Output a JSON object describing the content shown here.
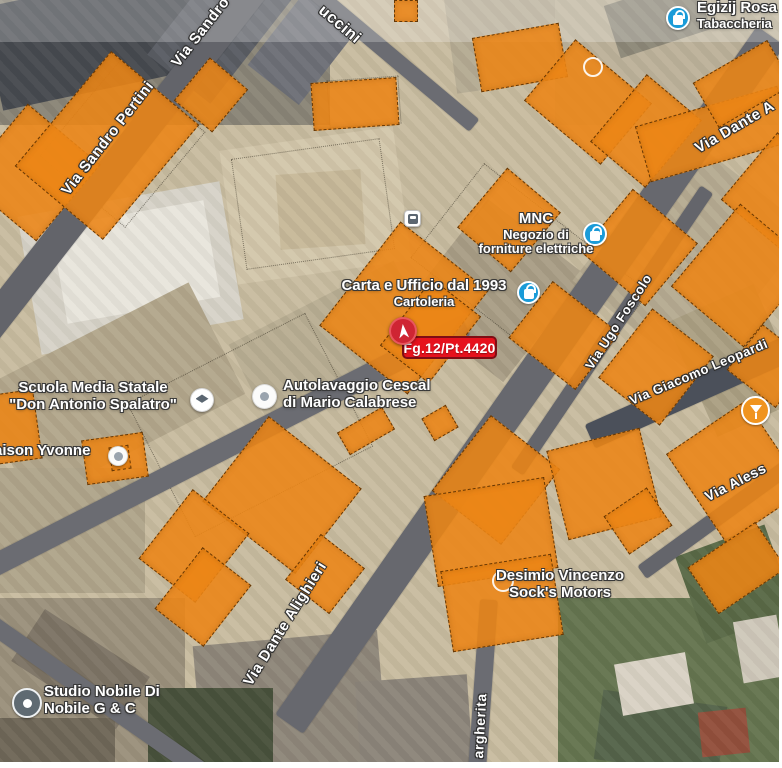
{
  "map": {
    "palette": {
      "map_bg": "#c8bca0",
      "parcel_fill": "#ec8516",
      "parcel_border": "#502a00",
      "road": "#63646a",
      "label_text": "#ffffff",
      "label_outline": "#2f2f2f",
      "badge_bg": "#e6121d",
      "badge_border": "#7e0d14",
      "marker_bg": "#cf2533",
      "poi_blue": "#1a9bd8",
      "poi_orange": "#f0941f",
      "poi_dark_pin": "#5f6a72"
    },
    "badge": {
      "label": "Fg.12/Pt.4420",
      "x": 402,
      "y": 336,
      "w": 95,
      "h": 23
    },
    "marker": {
      "x": 389,
      "y": 317,
      "d": 28
    },
    "streets": [
      {
        "label": "Via Sandro Pertini",
        "x": 58,
        "y": 188,
        "rot": -52,
        "fs": 15
      },
      {
        "label": "Via Sandro",
        "x": 168,
        "y": 60,
        "rot": -52,
        "fs": 15
      },
      {
        "label": "uccini",
        "x": 326,
        "y": 2,
        "rot": 40,
        "fs": 16
      },
      {
        "label": "Via Dante A",
        "x": 692,
        "y": 142,
        "rot": -30,
        "fs": 15
      },
      {
        "label": "Via Ugo Foscolo",
        "x": 582,
        "y": 364,
        "rot": -57,
        "fs": 13
      },
      {
        "label": "Via Giacomo Leopardi",
        "x": 627,
        "y": 394,
        "rot": -23,
        "fs": 13
      },
      {
        "label": "Via Aless",
        "x": 702,
        "y": 490,
        "rot": -27,
        "fs": 14
      },
      {
        "label": "Via Dante Alighieri",
        "x": 240,
        "y": 680,
        "rot": -58,
        "fs": 15
      },
      {
        "label": "argherita",
        "x": 470,
        "y": 758,
        "rot": -87,
        "fs": 14
      }
    ],
    "pois": [
      {
        "id": "tabaccheria",
        "icon": {
          "type": "bag",
          "x": 666,
          "y": 6,
          "d": 24
        },
        "text": {
          "align": "left",
          "x": 697,
          "y": 0,
          "lines": [
            "Egizij Rosa",
            "Tabaccheria"
          ],
          "fs": [
            15,
            13
          ]
        }
      },
      {
        "id": "mnc",
        "icon": {
          "type": "bag",
          "x": 583,
          "y": 222,
          "d": 24
        },
        "text": {
          "align": "center",
          "cx": 536,
          "y": 211,
          "lines": [
            "MNC",
            "Negozio di",
            "forniture elettriche"
          ],
          "fs": [
            15,
            13,
            13
          ]
        }
      },
      {
        "id": "cartoleria",
        "icon": {
          "type": "bag",
          "x": 517,
          "y": 281,
          "d": 23
        },
        "text": {
          "align": "center",
          "cx": 424,
          "y": 278,
          "lines": [
            "Carta e Ufficio dal 1993",
            "Cartoleria"
          ],
          "fs": [
            15,
            13
          ]
        }
      },
      {
        "id": "autolavaggio",
        "icon": {
          "type": "carwash",
          "x": 252,
          "y": 384,
          "d": 25
        },
        "text": {
          "align": "left",
          "x": 283,
          "y": 378,
          "lines": [
            "Autolavaggio Cescal",
            "di Mario Calabrese"
          ],
          "fs": [
            15,
            15
          ]
        }
      },
      {
        "id": "scuola",
        "icon": {
          "type": "school",
          "x": 190,
          "y": 388,
          "d": 24
        },
        "text": {
          "align": "center",
          "cx": 93,
          "y": 380,
          "lines": [
            "Scuola Media Statale",
            "\"Don Antonio Spalatro\""
          ],
          "fs": [
            15,
            15
          ]
        }
      },
      {
        "id": "yvonne",
        "icon": {
          "type": "carwash",
          "x": 108,
          "y": 446,
          "d": 20
        },
        "text": {
          "align": "left",
          "x": -6,
          "y": 443,
          "lines": [
            "aison Yvonne"
          ],
          "fs": [
            15
          ]
        }
      },
      {
        "id": "studio-nobile",
        "icon": {
          "type": "pin",
          "x": 12,
          "y": 688,
          "d": 30
        },
        "text": {
          "align": "left",
          "x": 44,
          "y": 684,
          "lines": [
            "Studio Nobile Di",
            "Nobile G & C"
          ],
          "fs": [
            15,
            15
          ]
        }
      },
      {
        "id": "desimio",
        "icon": {
          "type": "ring",
          "x": 492,
          "y": 570,
          "d": 22
        },
        "text": {
          "align": "center",
          "cx": 560,
          "y": 568,
          "lines": [
            "Desimio Vincenzo",
            "Sock's Motors"
          ],
          "fs": [
            15,
            15
          ]
        }
      },
      {
        "id": "bar",
        "icon": {
          "type": "cocktail",
          "x": 741,
          "y": 396,
          "d": 29
        }
      },
      {
        "id": "bus-stop",
        "icon": {
          "type": "bus",
          "x": 404,
          "y": 210,
          "d": 17
        }
      },
      {
        "id": "faded-poi",
        "icon": {
          "type": "ring",
          "x": 583,
          "y": 57,
          "d": 20
        }
      }
    ],
    "roads": [
      {
        "cx": 120,
        "cy": 160,
        "l": 500,
        "w": 30,
        "rot": -52,
        "c": "#63646a"
      },
      {
        "cx": 530,
        "cy": 380,
        "l": 840,
        "w": 34,
        "rot": -55,
        "c": "#67686e"
      },
      {
        "cx": 390,
        "cy": 55,
        "l": 220,
        "w": 16,
        "rot": 40,
        "c": "#6b6c72"
      },
      {
        "cx": 225,
        "cy": 448,
        "l": 540,
        "w": 22,
        "rot": -27,
        "c": "#6b6c72"
      },
      {
        "cx": 612,
        "cy": 330,
        "l": 340,
        "w": 15,
        "rot": -56,
        "c": "#64656b"
      },
      {
        "cx": 695,
        "cy": 390,
        "l": 230,
        "w": 26,
        "rot": -24,
        "c": "#4b505a"
      },
      {
        "cx": 735,
        "cy": 505,
        "l": 230,
        "w": 16,
        "rot": -36,
        "c": "#64656b"
      },
      {
        "cx": 482,
        "cy": 692,
        "l": 185,
        "w": 18,
        "rot": -86,
        "c": "#6b6c72"
      },
      {
        "cx": 100,
        "cy": 700,
        "l": 310,
        "w": 18,
        "rot": 35,
        "c": "#6b6c72"
      }
    ],
    "parcels": [
      {
        "x": -18,
        "y": 125,
        "w": 100,
        "h": 95,
        "rot": -50
      },
      {
        "x": 32,
        "y": 88,
        "w": 150,
        "h": 115,
        "rot": -50
      },
      {
        "x": 183,
        "y": 70,
        "w": 56,
        "h": 50,
        "rot": -50
      },
      {
        "x": 312,
        "y": 80,
        "w": 86,
        "h": 48,
        "rot": -4
      },
      {
        "x": 394,
        "y": 0,
        "w": 24,
        "h": 22,
        "rot": 0
      },
      {
        "x": 476,
        "y": 30,
        "w": 88,
        "h": 55,
        "rot": -10
      },
      {
        "x": 548,
        "y": 52,
        "w": 80,
        "h": 100,
        "rot": -50
      },
      {
        "x": 602,
        "y": 95,
        "w": 88,
        "h": 72,
        "rot": -50
      },
      {
        "x": 640,
        "y": 105,
        "w": 148,
        "h": 58,
        "rot": -16
      },
      {
        "x": 700,
        "y": 58,
        "w": 86,
        "h": 52,
        "rot": -30
      },
      {
        "x": 735,
        "y": 152,
        "w": 88,
        "h": 78,
        "rot": -50
      },
      {
        "x": 470,
        "y": 185,
        "w": 78,
        "h": 70,
        "rot": -50
      },
      {
        "x": 598,
        "y": 205,
        "w": 82,
        "h": 85,
        "rot": -50
      },
      {
        "x": 688,
        "y": 228,
        "w": 108,
        "h": 95,
        "rot": -50
      },
      {
        "x": 338,
        "y": 252,
        "w": 132,
        "h": 112,
        "rot": -52
      },
      {
        "x": 388,
        "y": 300,
        "w": 85,
        "h": 62,
        "rot": -52
      },
      {
        "x": 528,
        "y": 293,
        "w": 72,
        "h": 85,
        "rot": -52
      },
      {
        "x": 612,
        "y": 328,
        "w": 88,
        "h": 78,
        "rot": -52
      },
      {
        "x": 740,
        "y": 335,
        "w": 58,
        "h": 62,
        "rot": -52
      },
      {
        "x": -10,
        "y": 392,
        "w": 48,
        "h": 70,
        "rot": -8
      },
      {
        "x": 84,
        "y": 436,
        "w": 62,
        "h": 45,
        "rot": -8
      },
      {
        "x": 110,
        "y": 446,
        "w": 20,
        "h": 24,
        "rot": -8
      },
      {
        "x": 340,
        "y": 418,
        "w": 52,
        "h": 26,
        "rot": -30
      },
      {
        "x": 426,
        "y": 410,
        "w": 28,
        "h": 26,
        "rot": -30
      },
      {
        "x": 448,
        "y": 436,
        "w": 96,
        "h": 88,
        "rot": -52
      },
      {
        "x": 556,
        "y": 438,
        "w": 96,
        "h": 92,
        "rot": -14
      },
      {
        "x": 688,
        "y": 418,
        "w": 96,
        "h": 108,
        "rot": -34
      },
      {
        "x": 430,
        "y": 486,
        "w": 122,
        "h": 92,
        "rot": -9
      },
      {
        "x": 446,
        "y": 562,
        "w": 112,
        "h": 82,
        "rot": -9
      },
      {
        "x": 228,
        "y": 436,
        "w": 108,
        "h": 118,
        "rot": -52
      },
      {
        "x": 296,
        "y": 546,
        "w": 58,
        "h": 56,
        "rot": -52
      },
      {
        "x": 150,
        "y": 510,
        "w": 88,
        "h": 72,
        "rot": -52
      },
      {
        "x": 164,
        "y": 566,
        "w": 78,
        "h": 62,
        "rot": -52
      },
      {
        "x": 612,
        "y": 498,
        "w": 52,
        "h": 46,
        "rot": -34
      },
      {
        "x": 696,
        "y": 540,
        "w": 82,
        "h": 56,
        "rot": -34
      }
    ],
    "base_shapes": [
      {
        "c": "#8a8577",
        "x": 0,
        "y": 0,
        "w": 330,
        "h": 125,
        "rot": 0
      },
      {
        "c": "#474a50",
        "x": -10,
        "y": -15,
        "w": 210,
        "h": 105,
        "rot": -12
      },
      {
        "c": "#5a5d64",
        "x": 150,
        "y": -20,
        "w": 150,
        "h": 80,
        "rot": -52
      },
      {
        "c": "#6e7077",
        "x": 255,
        "y": 15,
        "w": 95,
        "h": 65,
        "rot": -52
      },
      {
        "c": "#b5ab93",
        "x": 450,
        "y": -10,
        "w": 130,
        "h": 95,
        "rot": -8
      },
      {
        "c": "#bdb29a",
        "x": 555,
        "y": 0,
        "w": 230,
        "h": 125,
        "rot": 0
      },
      {
        "c": "#8d8878",
        "x": 610,
        "y": -10,
        "w": 95,
        "h": 55,
        "rot": -18
      },
      {
        "c": "#d7d3c8",
        "x": 28,
        "y": 198,
        "w": 205,
        "h": 140,
        "rot": -10
      },
      {
        "c": "#e8e5dc",
        "x": 58,
        "y": 213,
        "w": 155,
        "h": 98,
        "rot": -10
      },
      {
        "c": "#d3c7ab",
        "x": 228,
        "y": 138,
        "w": 175,
        "h": 135,
        "rot": -8
      },
      {
        "c": "#c7b999",
        "x": 278,
        "y": 172,
        "w": 85,
        "h": 75,
        "rot": -4
      },
      {
        "c": "#b3a78c",
        "x": -10,
        "y": 330,
        "w": 240,
        "h": 125,
        "rot": -27
      },
      {
        "c": "#a99e86",
        "x": 428,
        "y": 228,
        "w": 135,
        "h": 125,
        "rot": -52
      },
      {
        "c": "#b6ab92",
        "x": 598,
        "y": 178,
        "w": 185,
        "h": 155,
        "rot": -52
      },
      {
        "c": "#aba083",
        "x": 688,
        "y": 298,
        "w": 95,
        "h": 125,
        "rot": -24
      },
      {
        "c": "#b9ae93",
        "x": 238,
        "y": 298,
        "w": 185,
        "h": 85,
        "rot": -27
      },
      {
        "c": "#b0a58b",
        "x": 0,
        "y": 468,
        "w": 145,
        "h": 125,
        "rot": 0
      },
      {
        "c": "#9b917c",
        "x": 0,
        "y": 598,
        "w": 185,
        "h": 170,
        "rot": 0
      },
      {
        "c": "#7d7465",
        "x": 18,
        "y": 638,
        "w": 125,
        "h": 62,
        "rot": 33
      },
      {
        "c": "#6f6758",
        "x": 0,
        "y": 718,
        "w": 115,
        "h": 50,
        "rot": 0
      },
      {
        "c": "#8f877a",
        "x": 198,
        "y": 638,
        "w": 185,
        "h": 130,
        "rot": -5
      },
      {
        "c": "#49523c",
        "x": 148,
        "y": 688,
        "w": 125,
        "h": 80,
        "rot": 0
      },
      {
        "c": "#657550",
        "x": 558,
        "y": 598,
        "w": 226,
        "h": 172,
        "rot": 0
      },
      {
        "c": "#5a6a47",
        "x": 688,
        "y": 538,
        "w": 95,
        "h": 92,
        "rot": -20
      },
      {
        "c": "#55644a",
        "x": 598,
        "y": 698,
        "w": 125,
        "h": 70,
        "rot": 8
      },
      {
        "c": "#93503c",
        "x": 700,
        "y": 710,
        "w": 48,
        "h": 45,
        "rot": -6
      },
      {
        "c": "#d9d2c4",
        "x": 618,
        "y": 658,
        "w": 72,
        "h": 52,
        "rot": -10
      },
      {
        "c": "#cfc8ba",
        "x": 738,
        "y": 618,
        "w": 44,
        "h": 62,
        "rot": -10
      },
      {
        "c": "#8c857a",
        "x": 358,
        "y": 678,
        "w": 112,
        "h": 90,
        "rot": -4
      }
    ],
    "cad_lines": [
      {
        "x": 238,
        "y": 148,
        "w": 150,
        "h": 112,
        "rot": -8
      },
      {
        "x": 328,
        "y": 78,
        "w": 72,
        "h": 48,
        "rot": -4
      },
      {
        "x": 60,
        "y": 88,
        "w": 125,
        "h": 112,
        "rot": -50
      },
      {
        "x": 470,
        "y": 170,
        "w": 120,
        "h": 210,
        "rot": -52
      },
      {
        "x": 150,
        "y": 350,
        "w": 200,
        "h": 150,
        "rot": -27
      }
    ]
  }
}
